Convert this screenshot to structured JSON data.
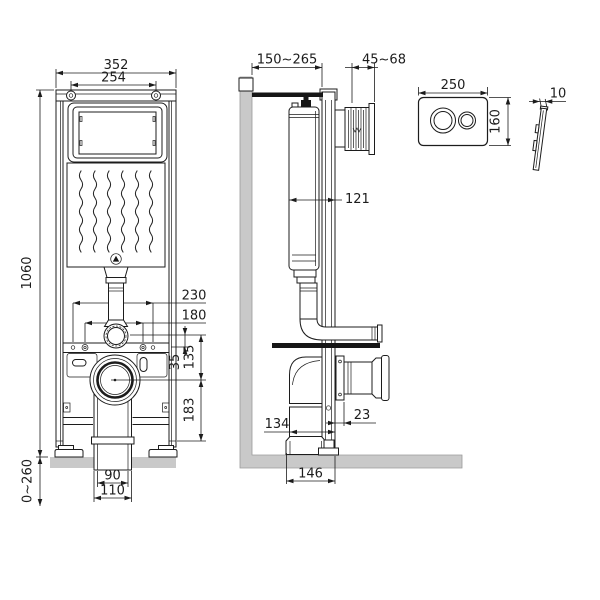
{
  "drawing": {
    "dims": {
      "front": {
        "width_overall": "352",
        "width_bolts": "254",
        "height": "1060",
        "feet_range": "0~260",
        "holes_outer": "230",
        "holes_inner": "180",
        "flange_to_bar": "35",
        "flange_to_outlet": "135",
        "outlet_to_floor": "183",
        "drain_inner": "90",
        "drain_outer": "110"
      },
      "side": {
        "wall_to_frame": "150~265",
        "finish_range": "45~68",
        "tank_depth": "121",
        "drain_to_frame": "134",
        "stud_offset": "23",
        "base_depth": "146"
      },
      "plate": {
        "width": "250",
        "height": "160",
        "thickness": "10"
      }
    }
  }
}
